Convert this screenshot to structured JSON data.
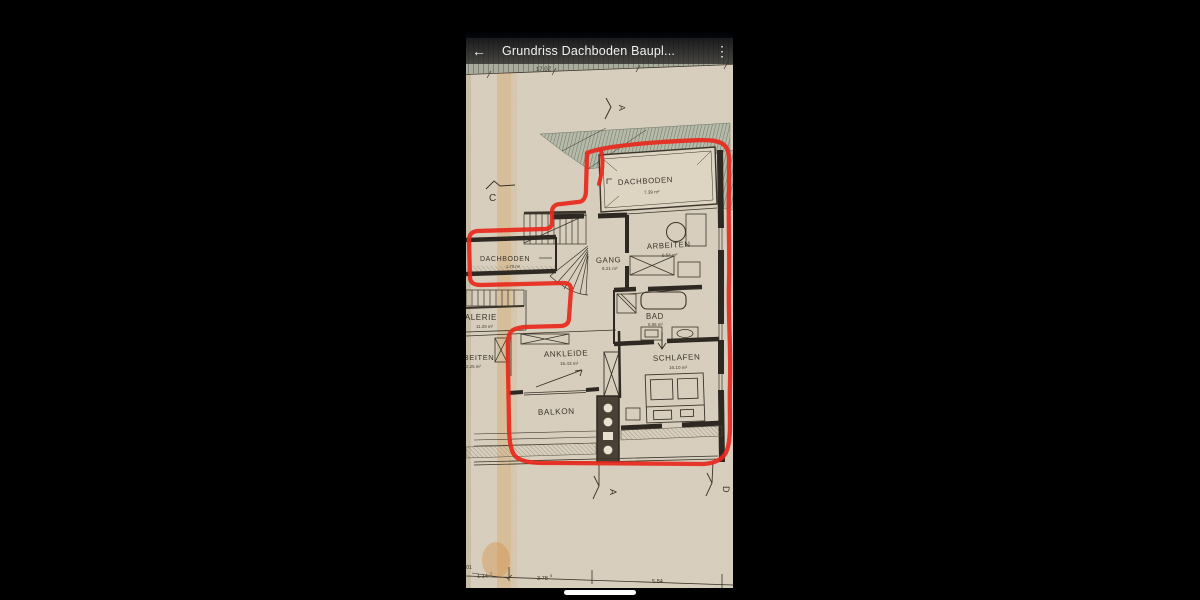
{
  "app_bar": {
    "back_icon": "←",
    "title": "Grundriss Dachboden Baupl...",
    "menu_icon": "⋮"
  },
  "colors": {
    "paper": "#d7cebd",
    "ink": "#3a3429",
    "wall": "#2d2821",
    "annotation_red": "#e8281c",
    "roof_hatch": "#b7bba9",
    "app_bar_text": "#f1f1f1"
  },
  "plan": {
    "rooms": {
      "dachboden_top": {
        "name": "DACHBODEN",
        "area": "7.39 m²"
      },
      "arbeiten_right": {
        "name": "ARBEITEN",
        "area": "9.54 m²"
      },
      "gang": {
        "name": "GANG",
        "area": "6.21 m²"
      },
      "dachboden_left": {
        "name": "DACHBODEN",
        "area": "1.70 m²"
      },
      "galerie": {
        "name": "GALERIE",
        "area": "11.29 m²"
      },
      "arbeiten_left": {
        "name": "ARBEITEN",
        "area": "2.25 m²"
      },
      "bad": {
        "name": "BAD",
        "area": "5.96 m²"
      },
      "ankleide": {
        "name": "ANKLEIDE",
        "area": "15.43 m²"
      },
      "schlafen": {
        "name": "SCHLAFEN",
        "area": "16.10 m²"
      },
      "balkon": {
        "name": "BALKON",
        "area": ""
      }
    },
    "dimensions": {
      "top": "17.02",
      "bottom_left": "01",
      "b1": "1.14",
      "b1_sup": "7",
      "b2": "3.78",
      "b2_sup": "5",
      "b3": "5.84"
    },
    "markers": {
      "c": "C",
      "a_top": "A",
      "a_bottom": "A",
      "d_bottom": "D"
    }
  }
}
